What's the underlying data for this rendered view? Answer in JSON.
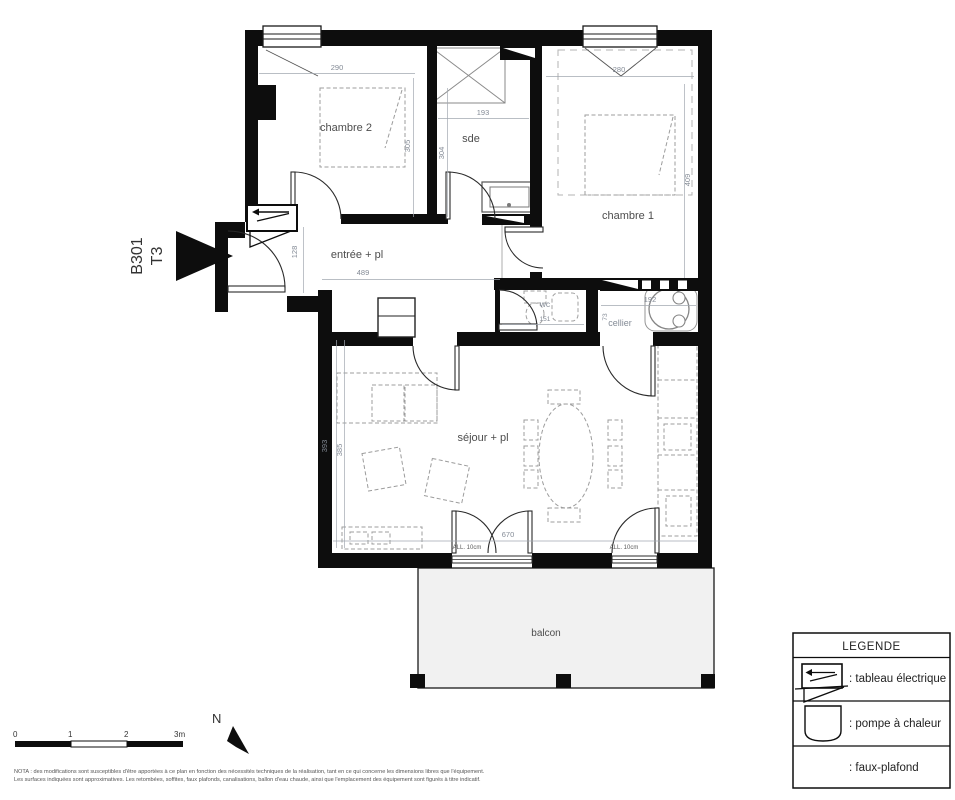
{
  "plan": {
    "unit": "B301",
    "type": "T3",
    "rooms": {
      "chambre2": {
        "label": "chambre 2",
        "dim_w": "290",
        "dim_h": "305"
      },
      "sde": {
        "label": "sde",
        "dim_w": "193",
        "dim_h": "304"
      },
      "chambre1": {
        "label": "chambre 1",
        "dim_w": "280",
        "dim_h": "409"
      },
      "entree": {
        "label": "entrée + pl",
        "dim_w": "489",
        "dim_h": "128"
      },
      "wc": {
        "label": "wc",
        "dim_w": "151"
      },
      "cellier": {
        "label": "cellier",
        "dim_w": "192",
        "dim_h": "73"
      },
      "sejour": {
        "label": "séjour + pl",
        "dim_h_outer": "393",
        "dim_h_inner": "385",
        "dim_w": "670"
      },
      "balcon": {
        "label": "balcon"
      }
    },
    "annotations": {
      "all_left": "ALL. 10cm",
      "all_right": "ALL. 10cm"
    }
  },
  "legend": {
    "title": "LEGENDE",
    "items": [
      {
        "label": ": tableau électrique"
      },
      {
        "label": ": pompe à chaleur"
      },
      {
        "label": ": faux-plafond"
      }
    ]
  },
  "scalebar": {
    "t0": "0",
    "t1": "1",
    "t2": "2",
    "t3": "3m"
  },
  "north": {
    "label": "N"
  },
  "nota": {
    "line1": "NOTA : des modifications sont susceptibles d'être apportées à ce plan en fonction des nécessités techniques de la réalisation, tant en ce qui concerne les dimensions libres que l'équipement.",
    "line2": "Les surfaces indiquées sont approximatives. Les retombées, soffites, faux plafonds, canalisations, ballon d'eau chaude, ainsi que l'emplacement des équipement sont figurés à titre indicatif."
  },
  "colors": {
    "wall": "#0d0d0d",
    "hatch": "#c9c9c9",
    "balcony_fill": "#f1f1f1",
    "dim_text": "#848b96",
    "label_text": "#4d4d4d"
  }
}
